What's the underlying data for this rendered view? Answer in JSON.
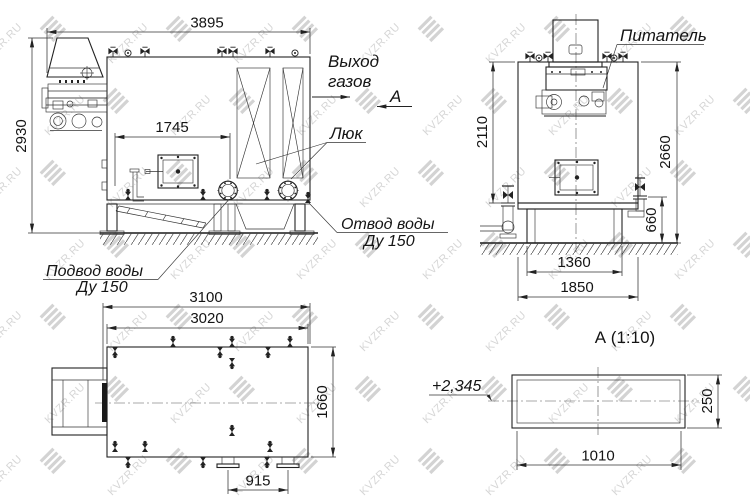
{
  "drawing": {
    "watermark": {
      "text": "KVZR.RU"
    },
    "labels": {
      "gas_outlet_line1": "Выход",
      "gas_outlet_line2": "газов",
      "view_marker": "А",
      "hatch": "Люк",
      "water_outlet_line1": "Отвод воды",
      "water_outlet_line2": "Ду 150",
      "water_supply_line1": "Подвод воды",
      "water_supply_line2": "Ду 150",
      "feeder": "Питатель",
      "detail_title": "А  (1:10)",
      "level_mark": "+2,345"
    },
    "dims": {
      "front_width": "3895",
      "front_height": "2930",
      "front_door_span": "1745",
      "side_height_upper": "2110",
      "side_height_overall": "2660",
      "side_base_height": "660",
      "side_base_inner": "1360",
      "side_depth": "1850",
      "plan_length_overall": "3100",
      "plan_length_body": "3020",
      "plan_width": "1660",
      "plan_flange_span": "915",
      "detail_length": "1010",
      "detail_height": "250"
    }
  }
}
